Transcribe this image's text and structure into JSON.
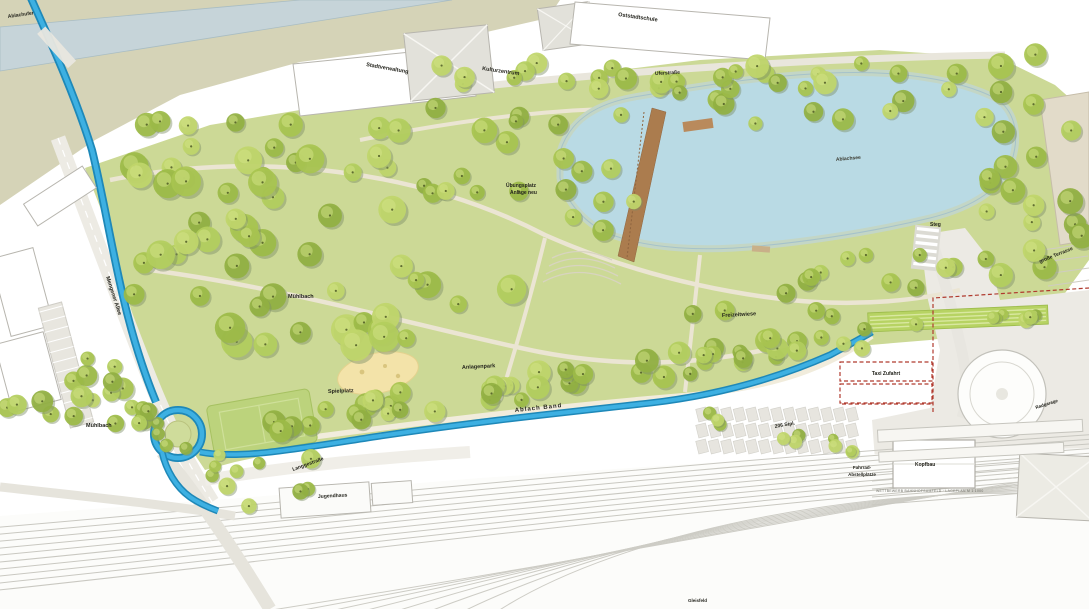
{
  "map": {
    "kind": "landscape master plan",
    "colors": {
      "park_green": "#ccd996",
      "tree_green": "#a8c44f",
      "stream_blue": "#3db0e2",
      "lake_blue": "#b9dae4",
      "canal_gray_blue": "#c6d4d9",
      "bank_olive": "#d5d3b7",
      "bridge_brown": "#ab7c4e",
      "accent_red": "#b03a2e",
      "playground_sand": "#f3e3a9"
    }
  },
  "labels": {
    "ablachufer": {
      "text": "Ablachufer"
    },
    "stadtverwaltung": {
      "text": "Stadtverwaltung"
    },
    "kulturzentrum": {
      "text": "Kulturzentrum"
    },
    "oststadtschule": {
      "text": "Oststadtschule"
    },
    "uferstrasse": {
      "text": "Uferstraße"
    },
    "see": {
      "text": "Ablachsee"
    },
    "uebungsplatz1": {
      "text": "Übungsplatz"
    },
    "uebungsplatz2": {
      "text": "Anlage neu"
    },
    "steg": {
      "text": "Steg"
    },
    "terrasse": {
      "text": "große Terrasse"
    },
    "muehlbach_nord": {
      "text": "Mühlbach"
    },
    "freizeitwiese": {
      "text": "Freizeitwiese"
    },
    "anlagenpark": {
      "text": "Anlagenpark"
    },
    "spielplatz": {
      "text": "Spielplatz"
    },
    "muehlbach_sued": {
      "text": "Mühlbach"
    },
    "allee": {
      "text": "Mengener Allee"
    },
    "ablachband": {
      "text": "Ablach Band"
    },
    "zufahrt": {
      "text": "Taxi Zufahrt"
    },
    "stellplaetze": {
      "text": "206 Stpl."
    },
    "fahrrad1": {
      "text": "Fahrrad-"
    },
    "fahrrad2": {
      "text": "Abstellplätze"
    },
    "kopfbau": {
      "text": "Kopfbau"
    },
    "langgestrasse": {
      "text": "Langgestraße"
    },
    "jugendhaus": {
      "text": "Jugendhaus"
    },
    "radgarage": {
      "text": "Radgarage"
    },
    "gleisfeld": {
      "text": "Gleisfeld"
    },
    "credit": {
      "text": "WETTBEWERB BAHNHOFSUMFELD · LAGEPLAN M 1:1000"
    }
  }
}
